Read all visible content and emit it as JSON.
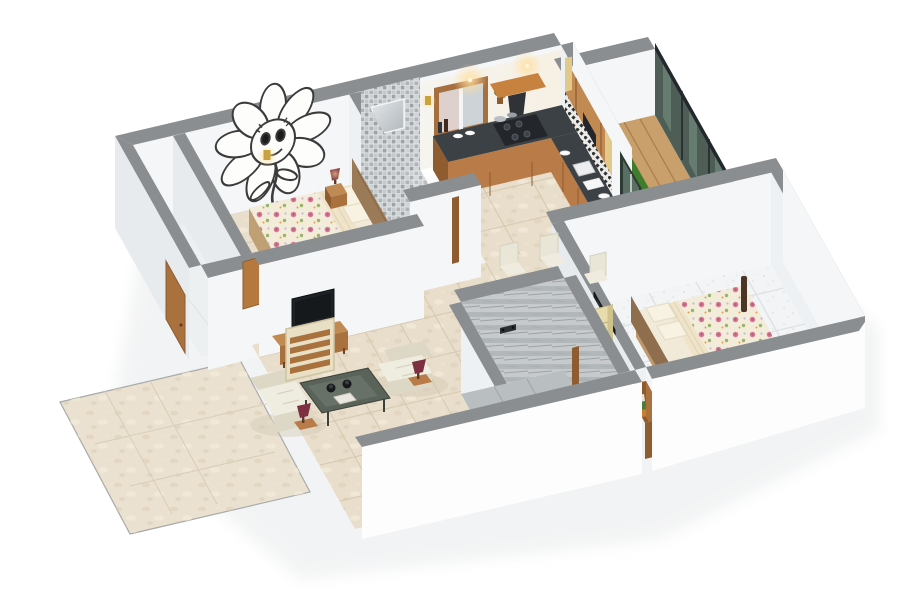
{
  "window": {
    "width": 900,
    "height": 600,
    "background": "#ffffff"
  },
  "scene": {
    "type": "3d-isometric-floor-plan-render",
    "description_semantic": "cutaway 3D render of a 2-bedroom apartment floor plan",
    "rooms": [
      {
        "name": "bedroom-1",
        "furniture": [
          "sunflower-wall-mural",
          "double-bed-floral",
          "upholstered-headboard",
          "pillows",
          "nightstand",
          "table-lamp",
          "wall-sconce",
          "book-ledge"
        ]
      },
      {
        "name": "bathroom-1",
        "furniture": [
          "mosaic-tile-wall",
          "mirror",
          "shower",
          "toilet",
          "washbasin"
        ]
      },
      {
        "name": "kitchen",
        "furniture": [
          "window",
          "chimney-hood",
          "gas-hob",
          "cookware",
          "granite-counter-back",
          "granite-counter-right",
          "sink",
          "plates",
          "upper-cabinets",
          "backsplash-tiles",
          "wall-plant",
          "ceiling-lights"
        ]
      },
      {
        "name": "balcony",
        "furniture": [
          "wood-deck",
          "grass-runner",
          "round-table-1",
          "round-table-2",
          "cafe-chair",
          "glass-railing",
          "sliding-glass-door"
        ]
      },
      {
        "name": "dining-area",
        "furniture": [
          "wooden-dining-table",
          "dining-chairs-x6",
          "place-settings-x6",
          "flower-centerpiece",
          "crockery-cabinet",
          "door-posts"
        ]
      },
      {
        "name": "living-room",
        "furniture": [
          "wall-tv",
          "tv-cabinet",
          "cream-sofa-1",
          "cream-sofa-2",
          "coffee-table",
          "side-lamp-1",
          "side-lamp-2",
          "slatted-wood-screen",
          "inner-door-leaf"
        ]
      },
      {
        "name": "entrance",
        "furniture": [
          "marble-entrance-mat",
          "entrance-door",
          "corridor"
        ]
      },
      {
        "name": "bathroom-2",
        "furniture": [
          "marble-tile-walls",
          "shower-mixer",
          "toilet",
          "pedestal-washbasin",
          "door-post"
        ]
      },
      {
        "name": "bedroom-2",
        "furniture": [
          "double-bed-floral",
          "headboard",
          "bed-posts",
          "wall-tv",
          "tv-cabinet",
          "low-bookshelf",
          "white-tile-floor"
        ]
      }
    ]
  },
  "palette": {
    "bg": "#ffffff",
    "wall_top": "#8a8e91",
    "wall_face": "#f5f6f7",
    "wall_west": "#e7ebee",
    "wall_east": "#e9edf0",
    "wall_inner": "#eef1f3",
    "floor_beige": "#e8decb",
    "floor_grout": "#d5c8ae",
    "floor_white": "#f2f4f6",
    "floor_white_grout": "#dfe2e4",
    "tile_gray": "#c3c7ca",
    "tile_grout": "#dfe2e4",
    "marble_gray": "#c6cacd",
    "wood": "#b97c48",
    "wood_dark": "#8f5c30",
    "wood_light": "#e2c98a",
    "counter": "#3c4146",
    "deck": "#c99f6b",
    "deck_line": "#a87f4e",
    "grass": "#3f7d2c",
    "grass_dark": "#2f6220",
    "glass": "#41524a",
    "glass_rail": "#23282c",
    "sofa_cream": "#efece0",
    "sofa_shade": "#ddd8c6",
    "red_accent": "#8e2026",
    "maroon_lamp": "#7c3040",
    "tv_black": "#1d2226",
    "gold": "#c9a23f",
    "bed_base": "#f2ead8",
    "pink_flower": "#d57a96",
    "leaf_green": "#9ab56a",
    "cream_cabinet": "#e7dcab",
    "mural_stroke": "#3b3b3b",
    "shadow": "#e9ebec"
  }
}
